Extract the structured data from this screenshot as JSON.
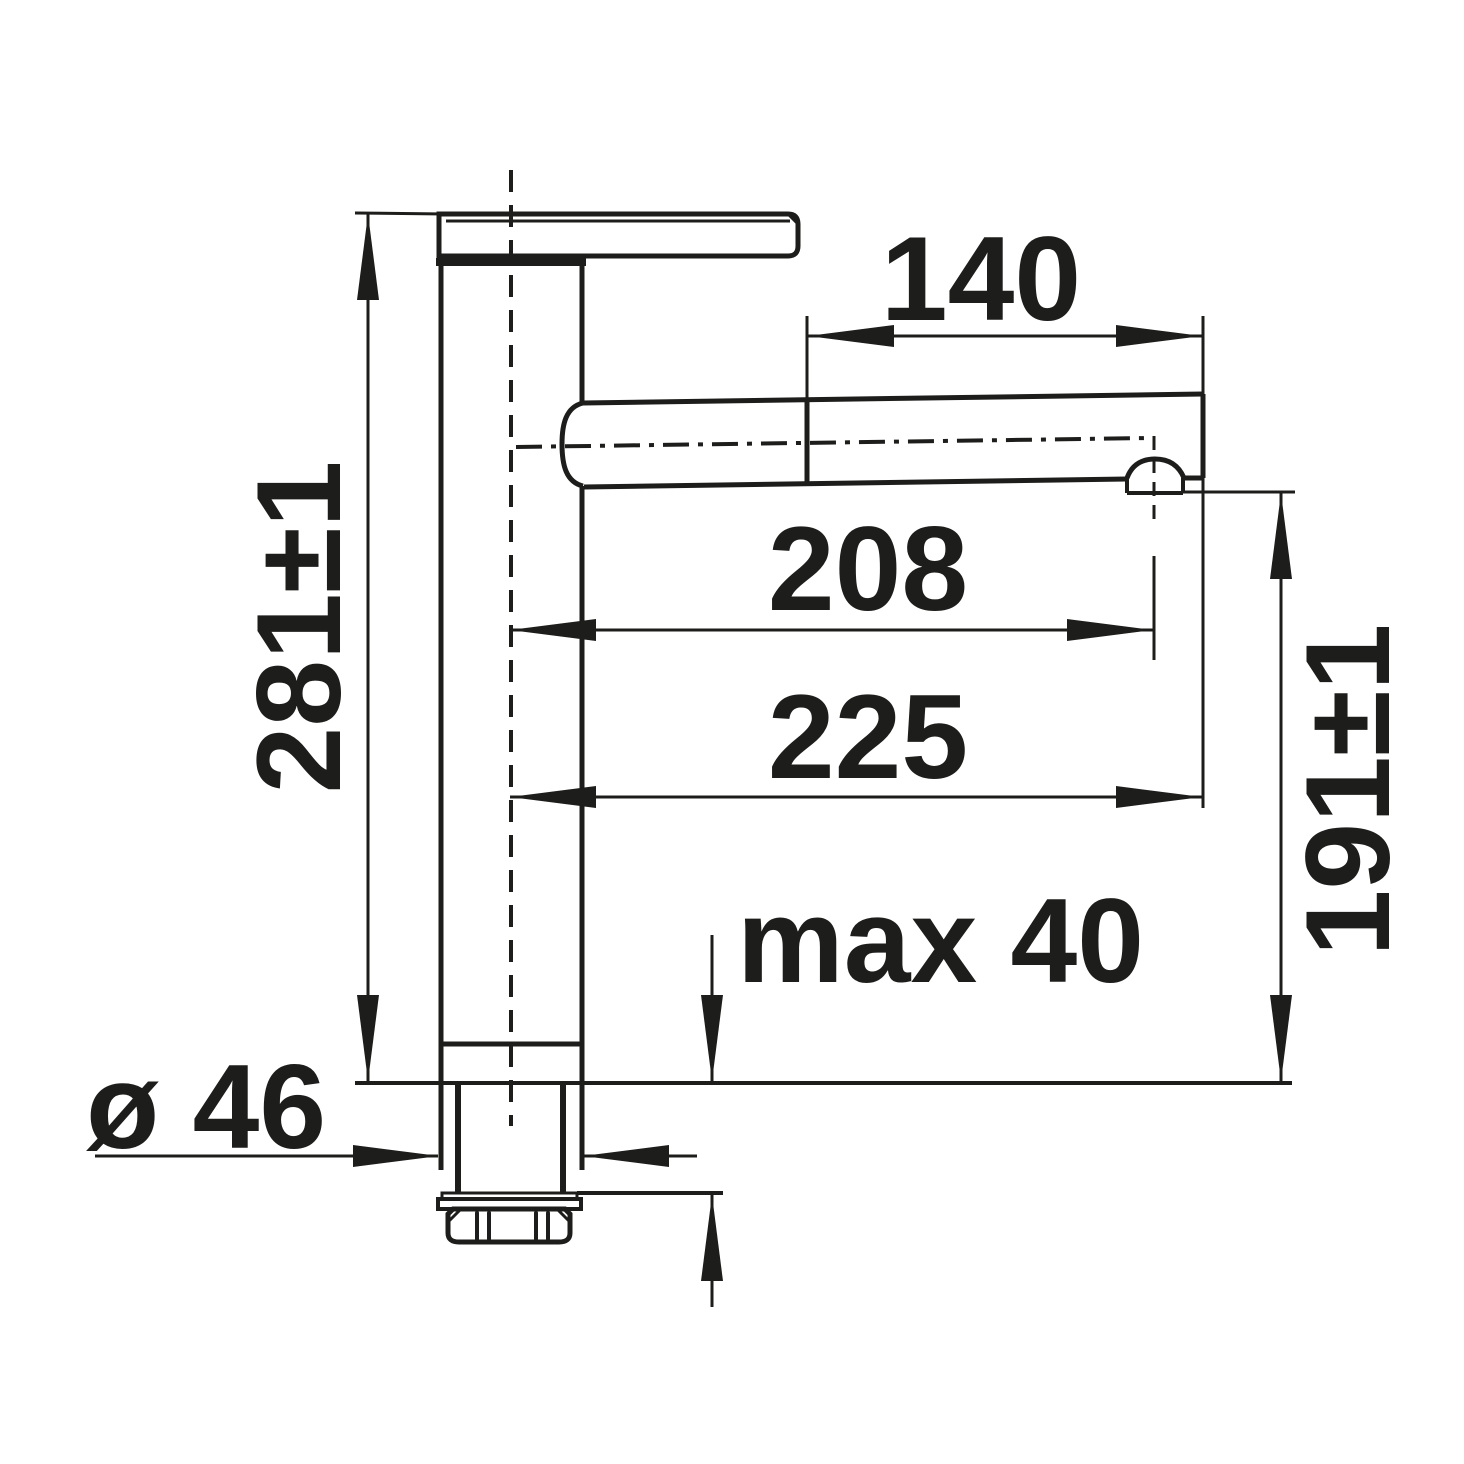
{
  "drawing": {
    "kind": "technical-dimension-drawing",
    "subject": "kitchen mixer tap side elevation with installation dimensions",
    "background_color": "#ffffff",
    "line_color": "#1d1d1b",
    "units": "mm"
  },
  "labels": {
    "total_height": "281±1",
    "pullout_spray_length": "140",
    "reach_to_aerator": "208",
    "reach_to_tip": "225",
    "outlet_height": "191±1",
    "max_deck_thickness": "max 40",
    "base_diameter": "ø 46"
  }
}
